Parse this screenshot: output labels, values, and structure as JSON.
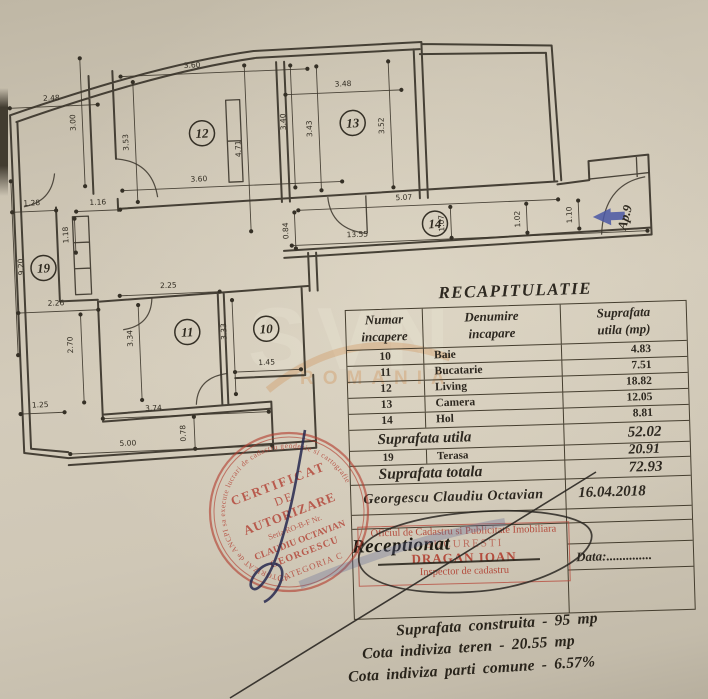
{
  "plan": {
    "rooms": [
      {
        "n": "12",
        "x": 207,
        "y": 128
      },
      {
        "n": "13",
        "x": 358,
        "y": 124
      },
      {
        "n": "14",
        "x": 436,
        "y": 228
      },
      {
        "n": "19",
        "x": 43,
        "y": 256
      },
      {
        "n": "11",
        "x": 184,
        "y": 326
      },
      {
        "n": "10",
        "x": 263,
        "y": 326
      }
    ],
    "dims": [
      {
        "t": "3.60",
        "x1": 128,
        "y1": 68,
        "x2": 315,
        "y2": 68,
        "lx": 200,
        "ly": 62,
        "r": 0
      },
      {
        "t": "2.48",
        "x1": 16,
        "y1": 95,
        "x2": 104,
        "y2": 95,
        "lx": 58,
        "ly": 89,
        "r": 0
      },
      {
        "t": "3.00",
        "x1": 88,
        "y1": 48,
        "x2": 88,
        "y2": 176,
        "lx": 81,
        "ly": 112,
        "r": -90
      },
      {
        "t": "3.53",
        "x1": 140,
        "y1": 74,
        "x2": 140,
        "y2": 194,
        "lx": 133,
        "ly": 134,
        "r": -90
      },
      {
        "t": "4.71",
        "x1": 252,
        "y1": 62,
        "x2": 252,
        "y2": 228,
        "lx": 245,
        "ly": 145,
        "r": -90
      },
      {
        "t": "3.60",
        "x1": 125,
        "y1": 182,
        "x2": 345,
        "y2": 182,
        "lx": 202,
        "ly": 176,
        "r": 0
      },
      {
        "t": "1.28",
        "x1": 14,
        "y1": 199,
        "x2": 58,
        "y2": 199,
        "lx": 34,
        "ly": 193,
        "r": 0
      },
      {
        "t": "1.16",
        "x1": 78,
        "y1": 201,
        "x2": 122,
        "y2": 201,
        "lx": 100,
        "ly": 195,
        "r": 0
      },
      {
        "t": "1.18",
        "x1": 76,
        "y1": 208,
        "x2": 76,
        "y2": 242,
        "lx": 69,
        "ly": 224,
        "r": -90
      },
      {
        "t": "9.20",
        "x1": 14,
        "y1": 168,
        "x2": 14,
        "y2": 342,
        "lx": 23,
        "ly": 254,
        "r": -90
      },
      {
        "t": "2.26",
        "x1": 16,
        "y1": 300,
        "x2": 96,
        "y2": 300,
        "lx": 54,
        "ly": 294,
        "r": 0
      },
      {
        "t": "2.70",
        "x1": 78,
        "y1": 304,
        "x2": 78,
        "y2": 392,
        "lx": 69,
        "ly": 334,
        "r": -90
      },
      {
        "t": "1.25",
        "x1": 14,
        "y1": 401,
        "x2": 58,
        "y2": 401,
        "lx": 34,
        "ly": 395,
        "r": 0
      },
      {
        "t": "2.25",
        "x1": 118,
        "y1": 287,
        "x2": 218,
        "y2": 287,
        "lx": 167,
        "ly": 281,
        "r": 0
      },
      {
        "t": "3.34",
        "x1": 136,
        "y1": 297,
        "x2": 136,
        "y2": 392,
        "lx": 129,
        "ly": 330,
        "r": -90
      },
      {
        "t": "3.33",
        "x1": 230,
        "y1": 296,
        "x2": 230,
        "y2": 390,
        "lx": 223,
        "ly": 327,
        "r": -90
      },
      {
        "t": "1.45",
        "x1": 230,
        "y1": 368,
        "x2": 296,
        "y2": 368,
        "lx": 262,
        "ly": 362,
        "r": 0
      },
      {
        "t": "3.74",
        "x1": 96,
        "y1": 409,
        "x2": 262,
        "y2": 409,
        "lx": 147,
        "ly": 403,
        "r": 0
      },
      {
        "t": "0.78",
        "x1": 187,
        "y1": 411,
        "x2": 187,
        "y2": 443,
        "lx": 178,
        "ly": 427,
        "r": -90
      },
      {
        "t": "5.00",
        "x1": 62,
        "y1": 443,
        "x2": 264,
        "y2": 443,
        "lx": 120,
        "ly": 437,
        "r": 0
      },
      {
        "t": "3.48",
        "x1": 292,
        "y1": 93,
        "x2": 408,
        "y2": 93,
        "lx": 350,
        "ly": 87,
        "r": 0
      },
      {
        "t": "3.40",
        "x1": 298,
        "y1": 64,
        "x2": 298,
        "y2": 186,
        "lx": 291,
        "ly": 120,
        "r": -90
      },
      {
        "t": "3.43",
        "x1": 324,
        "y1": 66,
        "x2": 324,
        "y2": 190,
        "lx": 317,
        "ly": 128,
        "r": -90
      },
      {
        "t": "3.52",
        "x1": 396,
        "y1": 64,
        "x2": 396,
        "y2": 190,
        "lx": 389,
        "ly": 128,
        "r": -90
      },
      {
        "t": "5.07",
        "x1": 300,
        "y1": 209,
        "x2": 560,
        "y2": 209,
        "lx": 406,
        "ly": 203,
        "r": 0
      },
      {
        "t": "13.55",
        "x1": 292,
        "y1": 244,
        "x2": 648,
        "y2": 244,
        "lx": 358,
        "ly": 238,
        "r": 0
      },
      {
        "t": "1.07",
        "x1": 452,
        "y1": 212,
        "x2": 452,
        "y2": 243,
        "lx": 445,
        "ly": 228,
        "r": -90
      },
      {
        "t": "1.02",
        "x1": 528,
        "y1": 212,
        "x2": 528,
        "y2": 241,
        "lx": 521,
        "ly": 227,
        "r": -90
      },
      {
        "t": "1.10",
        "x1": 580,
        "y1": 211,
        "x2": 580,
        "y2": 239,
        "lx": 573,
        "ly": 225,
        "r": -90
      },
      {
        "t": "0.84",
        "x1": 296,
        "y1": 211,
        "x2": 296,
        "y2": 247,
        "lx": 289,
        "ly": 229,
        "r": -90
      }
    ],
    "entrance": {
      "label": "Ap.9",
      "x": 630,
      "y": 231,
      "rot": -72
    }
  },
  "watermark": {
    "big": "SVN",
    "small": "ROMANIA"
  },
  "table": {
    "title": "RECAPITULATIE",
    "headers": {
      "col1a": "Numar",
      "col1b": "incapere",
      "col2a": "Denumire",
      "col2b": "incapare",
      "col3a": "Suprafata",
      "col3b": "utila  (mp)"
    },
    "rows": [
      {
        "num": "10",
        "name": "Baie",
        "area": "4.83"
      },
      {
        "num": "11",
        "name": "Bucatarie",
        "area": "7.51"
      },
      {
        "num": "12",
        "name": "Living",
        "area": "18.82"
      },
      {
        "num": "13",
        "name": "Camera",
        "area": "12.05"
      },
      {
        "num": "14",
        "name": "Hol",
        "area": "8.81"
      }
    ],
    "subtotal_label": "Suprafata utila",
    "subtotal_value": "52.02",
    "terasa_row": {
      "num": "19",
      "name": "Terasa",
      "area": "20.91"
    },
    "total_label": "Suprafata totala",
    "total_value": "72.93",
    "author": "Georgescu  Claudiu  Octavian",
    "date": "16.04.2018",
    "data_label": "Data:.............."
  },
  "stamps": {
    "round": {
      "ring": "AUTORIZAT de ANCPI sa execute lucrari de cadastru geodezie si cartografie",
      "line1": "CERTIFICAT",
      "line2": "DE",
      "line3": "AUTORIZARE",
      "line4": "Seria RO-B-F Nr.",
      "line5": "CLAUDIU OCTAVIAN",
      "line6": "GEORGESCU",
      "line7": "CATEGORIA C"
    },
    "office": {
      "line1": "Oficiul de Cadastru si Publicitate Imobiliara",
      "line2": "BUCURESTI",
      "line3": "DRAGAN IOAN",
      "line4": "Inspector de cadastru"
    },
    "received_label": "Receptionat"
  },
  "summary": {
    "line1": "Suprafata construita - 95 mp",
    "line2": "Cota indiviza teren - 20.55 mp",
    "line3": "Cota indiviza parti comune - 6.57%"
  }
}
